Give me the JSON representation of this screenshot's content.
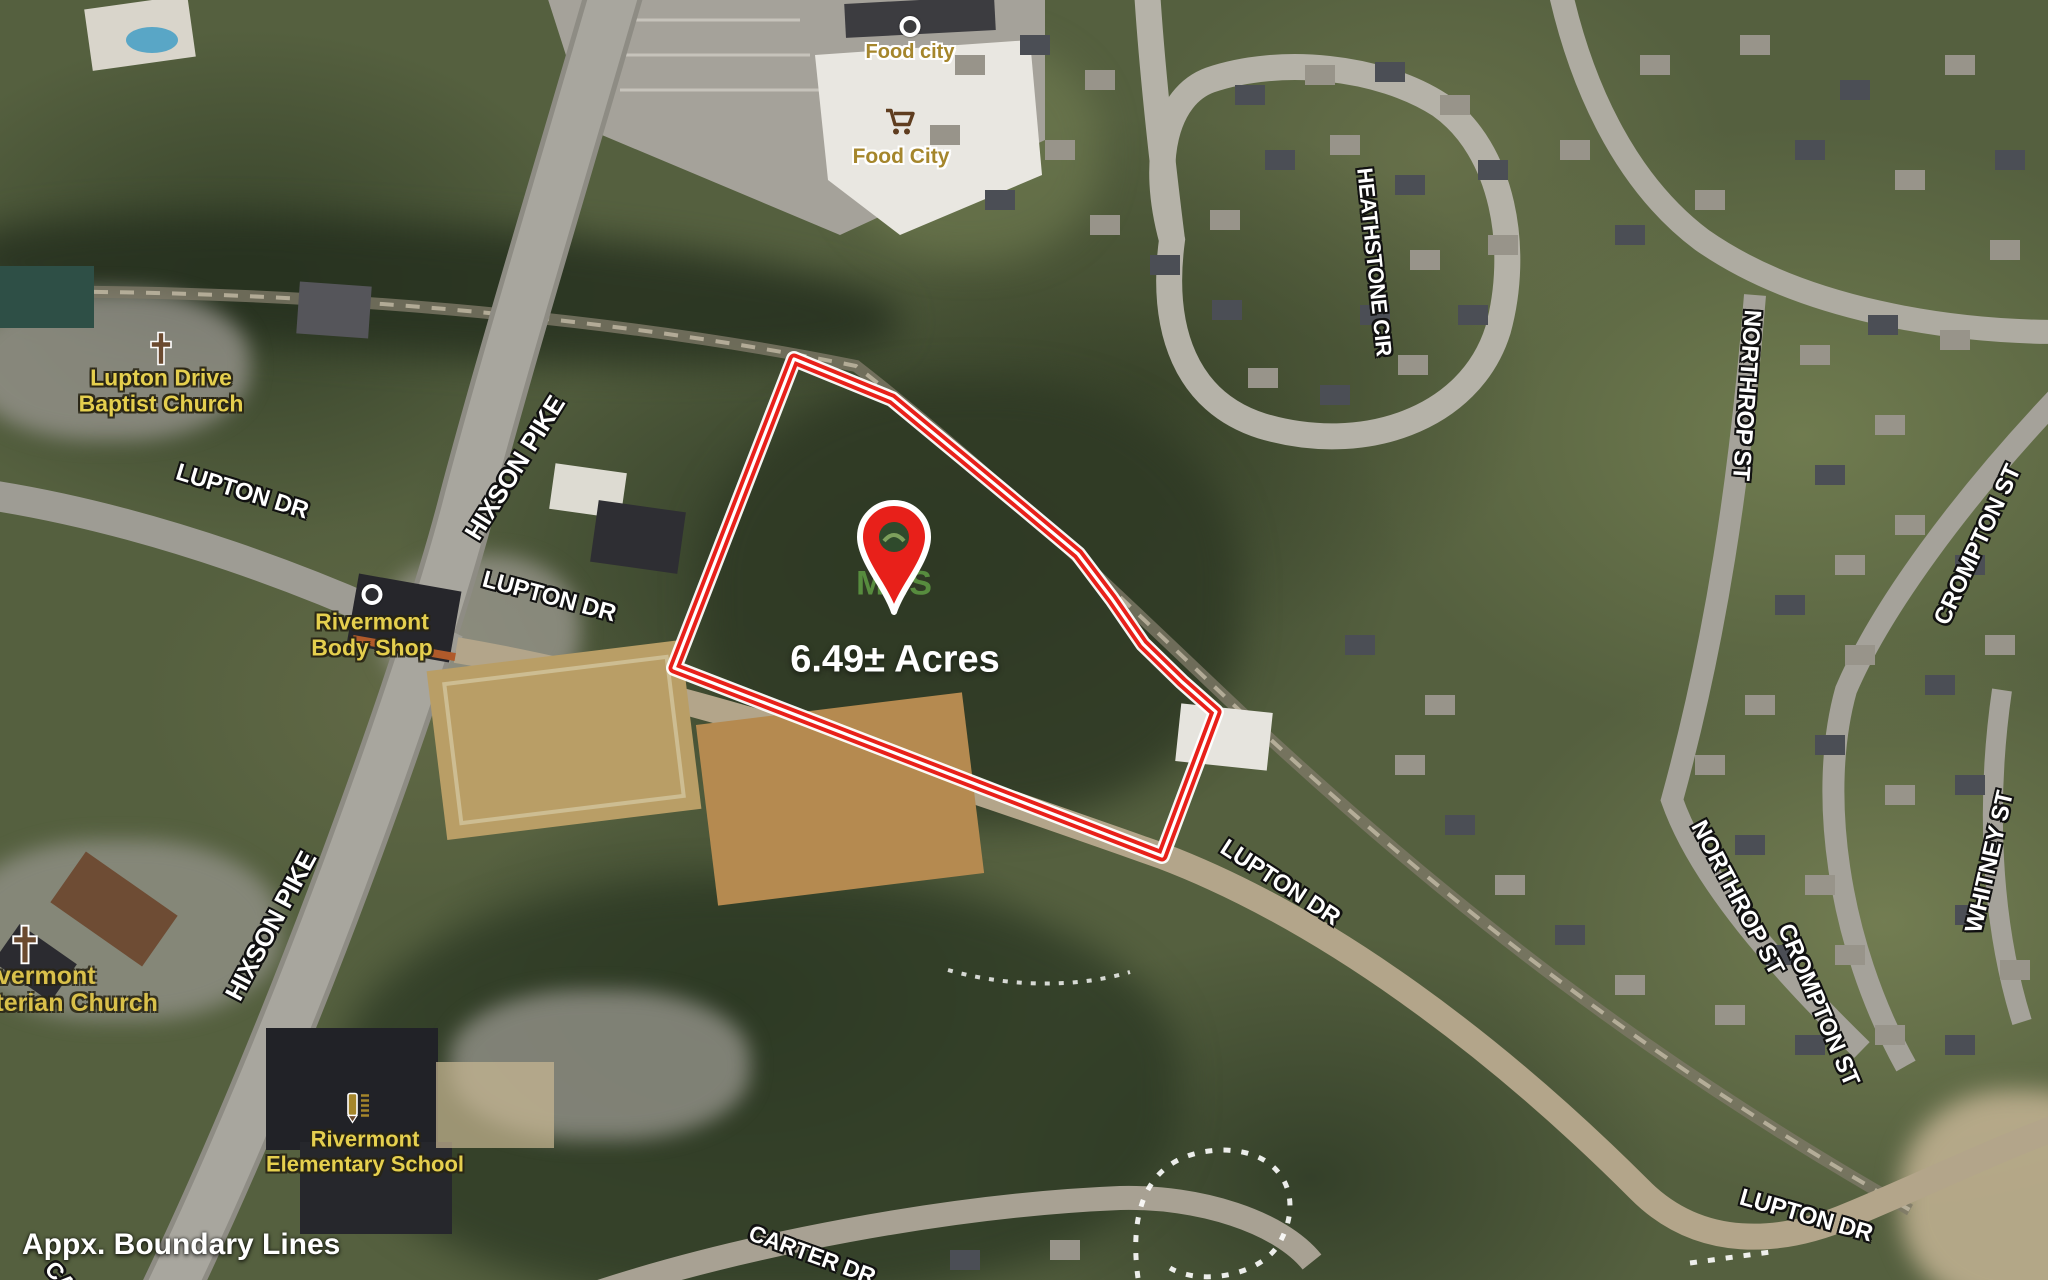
{
  "overlay": {
    "acreage": "6.49± Acres",
    "boundary_note": "Appx. Boundary Lines",
    "watermark": "MLS"
  },
  "boundary": {
    "color": "#e8201a",
    "casing_color": "#ffffff",
    "points": [
      [
        794,
        359
      ],
      [
        892,
        399
      ],
      [
        962,
        457
      ],
      [
        1022,
        507
      ],
      [
        1078,
        554
      ],
      [
        1112,
        599
      ],
      [
        1143,
        644
      ],
      [
        1182,
        682
      ],
      [
        1216,
        712
      ],
      [
        1162,
        856
      ],
      [
        674,
        668
      ]
    ]
  },
  "pin": {
    "color": "#e8201a",
    "x": 894,
    "tip_y": 618
  },
  "streets": [
    "HIXSON PIKE",
    "LUPTON DR",
    "LUPTON DR",
    "HEATHSTONE CIR",
    "NORTHROP ST",
    "CROMPTON ST",
    "WHITNEY ST",
    "NORTHROP ST",
    "CROMPTON ST",
    "HIXSON PIKE",
    "LUPTON DR",
    "LUPTON DR",
    "CARTER DR",
    "CA"
  ],
  "pois": {
    "food_city_small": "Food city",
    "food_city_large": "Food City",
    "baptist_church_line1": "Lupton Drive",
    "baptist_church_line2": "Baptist Church",
    "body_shop_line1": "Rivermont",
    "body_shop_line2": "Body Shop",
    "presbyterian_line1": "Rivermont",
    "presbyterian_line2": "Presbyterian Church",
    "elementary_line1": "Rivermont",
    "elementary_line2": "Elementary School"
  },
  "icons": {
    "map-pin-icon": "red teardrop with hole",
    "cross-icon": "christian cross",
    "shopping-cart-icon": "cart",
    "location-dot-icon": "white ring dot",
    "school-pencil-icon": "pencil with ruled lines"
  }
}
